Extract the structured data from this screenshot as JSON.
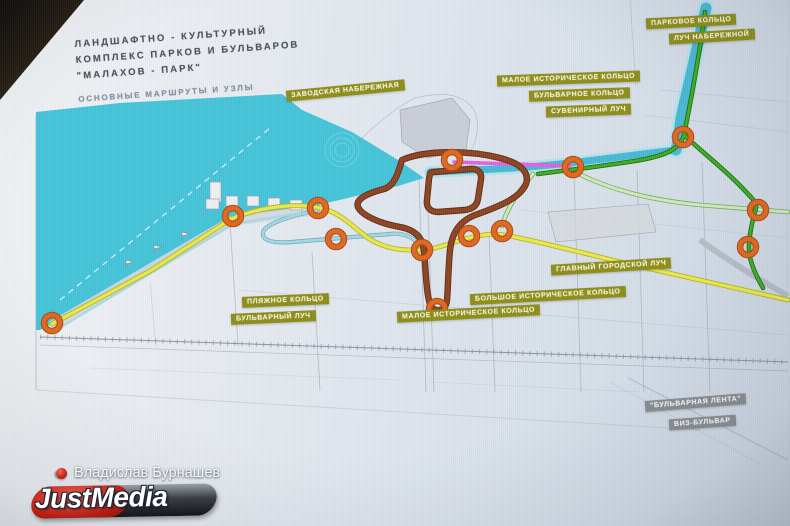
{
  "title": {
    "line1": "ЛАНДШАФТНО - КУЛЬТУРНЫЙ",
    "line2": "КОМПЛЕКС ПАРКОВ И БУЛЬВАРОВ",
    "line3": "\"МАЛАХОВ - ПАРК\"",
    "subtitle": "ОСНОВНЫЕ МАРШРУТЫ И УЗЛЫ"
  },
  "map_labels": [
    {
      "id": "zavodskaya-naberezhnaya",
      "text": "ЗАВОДСКАЯ НАБЕРЕЖНАЯ",
      "x": 286,
      "y": 85,
      "rot": -5.5,
      "variant": "olive"
    },
    {
      "id": "maloe-istoricheskoe-kolco-top",
      "text": "МАЛОЕ ИСТОРИЧЕСКОЕ КОЛЬЦО",
      "x": 497,
      "y": 73,
      "rot": -2,
      "variant": "olive"
    },
    {
      "id": "bulvarnoe-kolco",
      "text": "БУЛЬВАРНОЕ КОЛЬЦО",
      "x": 529,
      "y": 89,
      "rot": -2,
      "variant": "olive"
    },
    {
      "id": "suvenirny-luch",
      "text": "СУВЕНИРНЫЙ ЛУЧ",
      "x": 546,
      "y": 105,
      "rot": -2,
      "variant": "olive"
    },
    {
      "id": "parkovoe-kolco",
      "text": "ПАРКОВОЕ КОЛЬЦО",
      "x": 646,
      "y": 16,
      "rot": -3,
      "variant": "olive"
    },
    {
      "id": "luch-naberezhnoy",
      "text": "ЛУЧ НАБЕРЕЖНОЙ",
      "x": 669,
      "y": 31,
      "rot": -3.5,
      "variant": "olive"
    },
    {
      "id": "glavny-gorodskoy-luch",
      "text": "ГЛАВНЫЙ ГОРОДСКОЙ ЛУЧ",
      "x": 551,
      "y": 261,
      "rot": -3.5,
      "variant": "olive"
    },
    {
      "id": "bolshoe-istoricheskoe-kolco",
      "text": "БОЛЬШОЕ ИСТОРИЧЕСКОЕ КОЛЬЦО",
      "x": 470,
      "y": 290,
      "rot": -3,
      "variant": "olive"
    },
    {
      "id": "maloe-istoricheskoe-kolco-bottom",
      "text": "МАЛОЕ ИСТОРИЧЕСКОЕ КОЛЬЦО",
      "x": 397,
      "y": 308,
      "rot": -3,
      "variant": "olive"
    },
    {
      "id": "plyazhnoe-kolco",
      "text": "ПЛЯЖНОЕ КОЛЬЦО",
      "x": 242,
      "y": 295,
      "rot": -2.5,
      "variant": "olive"
    },
    {
      "id": "bulvarny-luch",
      "text": "БУЛЬВАРНЫЙ ЛУЧ",
      "x": 231,
      "y": 312,
      "rot": -2.5,
      "variant": "olive"
    },
    {
      "id": "bulvarnaya-lenta",
      "text": "\"БУЛЬВАРНАЯ ЛЕНТА\"",
      "x": 645,
      "y": 397,
      "rot": -4.5,
      "variant": "gray"
    },
    {
      "id": "viz-bulvar",
      "text": "ВИЗ-БУЛЬВАР",
      "x": 669,
      "y": 417,
      "rot": -4,
      "variant": "gray"
    }
  ],
  "nodes": [
    [
      52,
      323
    ],
    [
      233,
      216
    ],
    [
      318,
      208
    ],
    [
      336,
      239
    ],
    [
      422,
      250
    ],
    [
      452,
      160
    ],
    [
      469,
      236
    ],
    [
      502,
      231
    ],
    [
      437,
      309
    ],
    [
      573,
      167
    ],
    [
      683,
      137
    ],
    [
      758,
      210
    ],
    [
      748,
      247
    ]
  ],
  "colors": {
    "water": "#45c4d9",
    "river": "#4ab9d4",
    "route_yellow": "#e9e94f",
    "route_yellow_edge": "#b5b52e",
    "route_brown": "#8e4423",
    "route_brown_edge": "#5f2d12",
    "route_green": "#3fae24",
    "route_green_edge": "#1e6e12",
    "route_pale_green": "#cfe9c2",
    "route_pale_green_edge": "#74aa58",
    "route_light_blue": "#a5d8e4",
    "route_light_blue_edge": "#6aa8bc",
    "route_magenta": "#e95fe0",
    "node_orange": "#e2681f",
    "node_orange_edge": "#a84a14",
    "label_olive": "#8e8e1a",
    "label_gray": "#8a8d92",
    "street": "#9aa2ac"
  },
  "watermark": {
    "author": "Владислав Бурнашев",
    "logo_part1": "Just",
    "logo_part2": "Media"
  }
}
